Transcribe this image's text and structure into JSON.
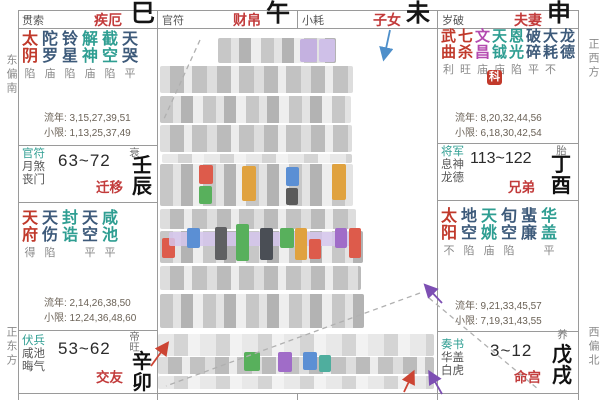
{
  "ribbon": [
    {
      "god": "贯索",
      "palace": "疾厄",
      "branch": "巳"
    },
    {
      "god": "官符",
      "palace": "财帛",
      "branch": "午"
    },
    {
      "god": "小耗",
      "palace": "子女",
      "branch": "未"
    },
    {
      "god": "岁破",
      "palace": "夫妻",
      "branch": "申"
    }
  ],
  "cells": {
    "chen": {
      "stars": [
        {
          "n": "太阴",
          "c": "red",
          "b": "陷"
        },
        {
          "n": "陀罗",
          "c": "navy",
          "b": "庙"
        },
        {
          "n": "铃星",
          "c": "navy",
          "b": "陷"
        },
        {
          "n": "解神",
          "c": "teal",
          "b": "庙"
        },
        {
          "n": "截空",
          "c": "teal",
          "b": "陷"
        },
        {
          "n": "天哭",
          "c": "navy",
          "b": "平"
        }
      ],
      "liunian": "流年: 3,15,27,39,51",
      "xiaoxian": "小限: 1,13,25,37,49",
      "gods": [
        "官符",
        "月煞",
        "丧门"
      ],
      "range": "63~72",
      "palace": "迁移",
      "sheng": "衰",
      "gz": [
        "壬",
        "辰"
      ]
    },
    "mao": {
      "stars": [
        {
          "n": "天府",
          "c": "red",
          "b": "得"
        },
        {
          "n": "天伤",
          "c": "navy",
          "b": "陷"
        },
        {
          "n": "封诰",
          "c": "teal",
          "b": ""
        },
        {
          "n": "天空",
          "c": "navy",
          "b": "平"
        },
        {
          "n": "咸池",
          "c": "teal",
          "b": "平"
        }
      ],
      "liunian": "流年: 2,14,26,38,50",
      "xiaoxian": "小限: 12,24,36,48,60",
      "gods": [
        "伏兵",
        "咸池",
        "晦气"
      ],
      "range": "53~62",
      "palace": "交友",
      "sheng": "帝旺",
      "gz": [
        "辛",
        "卯"
      ]
    },
    "you": {
      "stars": [
        {
          "n": "武曲",
          "c": "red",
          "b": "利"
        },
        {
          "n": "七杀",
          "c": "red",
          "b": "旺"
        },
        {
          "n": "文昌",
          "c": "mag",
          "b": "庙"
        },
        {
          "n": "天钺",
          "c": "teal",
          "b": "庙"
        },
        {
          "n": "恩光",
          "c": "teal",
          "b": "陷"
        },
        {
          "n": "破碎",
          "c": "navy",
          "b": "平"
        },
        {
          "n": "大耗",
          "c": "navy",
          "b": "不"
        },
        {
          "n": "龙德",
          "c": "navy",
          "b": ""
        }
      ],
      "hua": "科",
      "liunian": "流年: 8,20,32,44,56",
      "xiaoxian": "小限: 6,18,30,42,54",
      "gods": [
        "将军",
        "息神",
        "龙德"
      ],
      "range": "113~122",
      "palace": "兄弟",
      "sheng": "胎",
      "gz": [
        "丁",
        "酉"
      ]
    },
    "xu": {
      "stars": [
        {
          "n": "太阳",
          "c": "red",
          "b": "不"
        },
        {
          "n": "地空",
          "c": "navy",
          "b": "陷"
        },
        {
          "n": "天姚",
          "c": "teal",
          "b": "庙"
        },
        {
          "n": "旬空",
          "c": "navy",
          "b": "陷"
        },
        {
          "n": "蜚廉",
          "c": "navy",
          "b": ""
        },
        {
          "n": "华盖",
          "c": "teal",
          "b": "平"
        }
      ],
      "liunian": "流年: 9,21,33,45,57",
      "xiaoxian": "小限: 7,19,31,43,55",
      "gods": [
        "奏书",
        "华盖",
        "白虎"
      ],
      "range": "3~12",
      "palace": "命宫",
      "sheng": "养",
      "gz": [
        "戊",
        "戌"
      ]
    }
  },
  "compass": {
    "tl": "东偏南",
    "bl": "正东方",
    "tr": "正西方",
    "br": "西偏北"
  },
  "bottom": [
    "小三天",
    "紫破左右红鸾",
    "天地八天天天",
    "天刑铃天"
  ],
  "colors": {
    "major_star": "#c0392b",
    "lucky_star": "#2f9e92",
    "minor_star": "#3d5a7a",
    "wenchang_star": "#b44bb0",
    "palace_name": "#c23b3b",
    "hua_badge": "#c2392b",
    "god_first": "#2f9e92"
  }
}
